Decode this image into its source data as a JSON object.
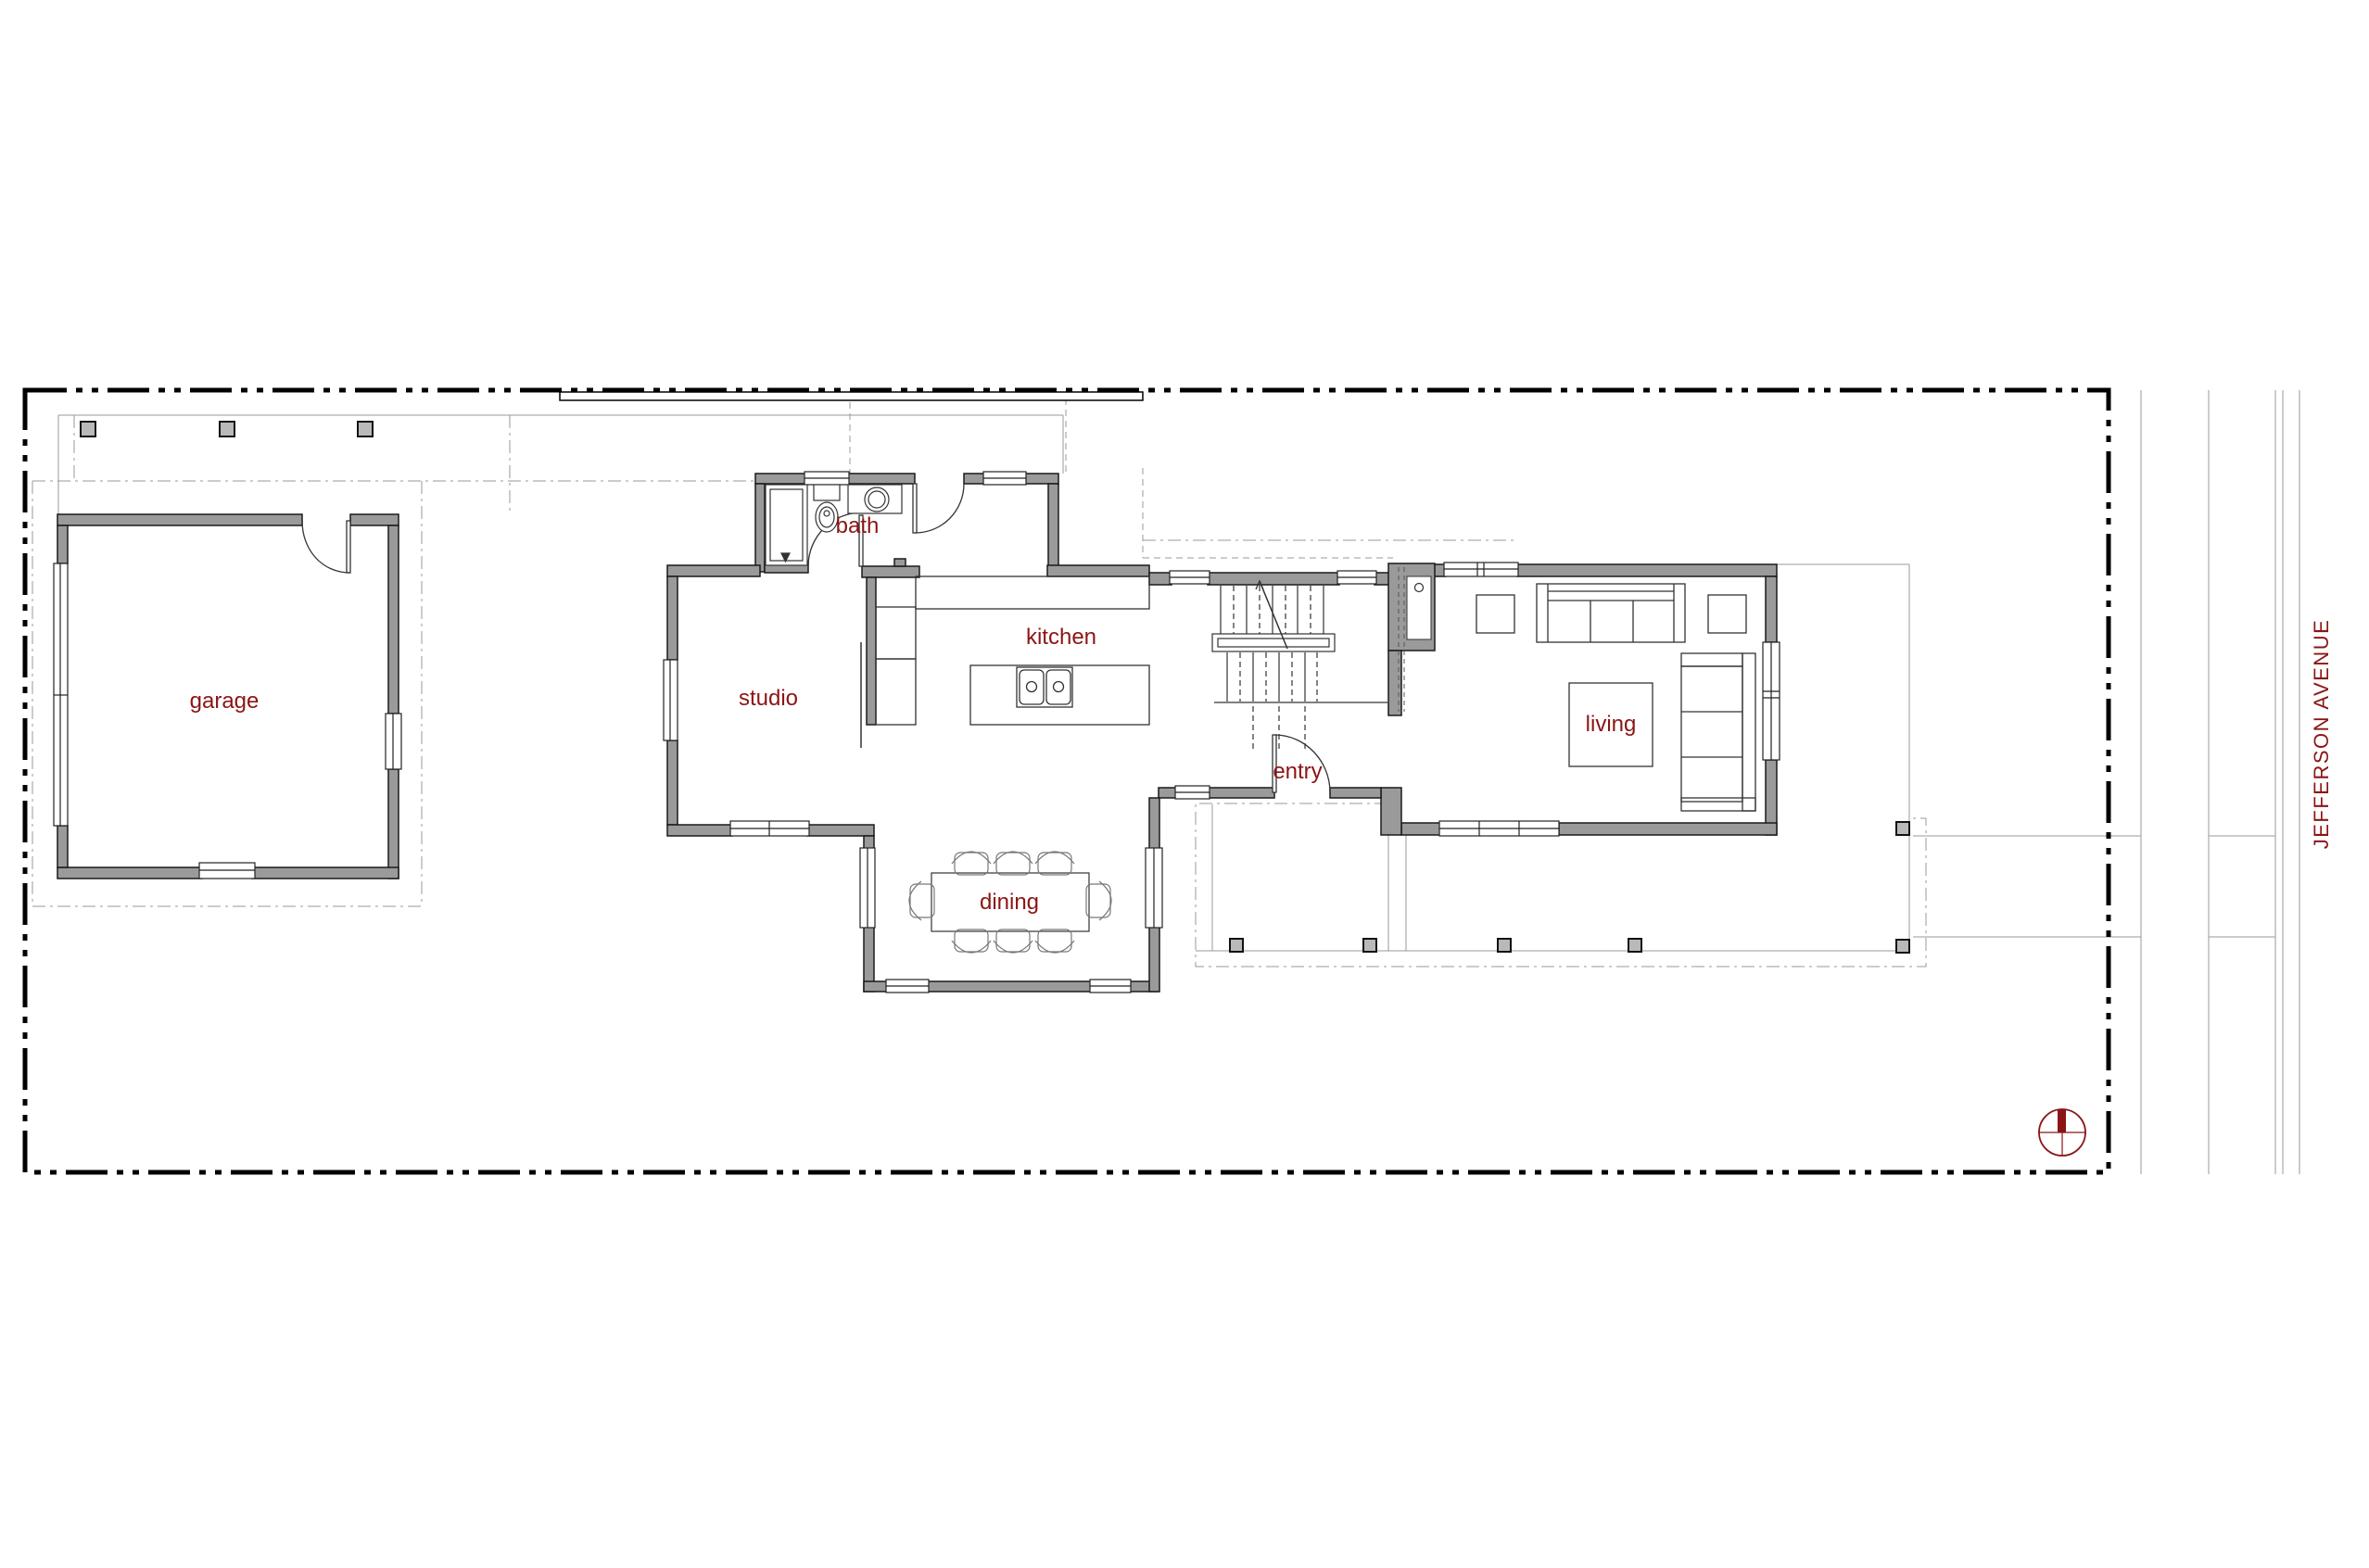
{
  "plan": {
    "rooms": {
      "garage": "garage",
      "studio": "studio",
      "bath": "bath",
      "kitchen": "kitchen",
      "entry": "entry",
      "living": "living",
      "dining": "dining"
    },
    "street": {
      "name": "JEFFERSON AVENUE"
    },
    "icons": {
      "north_arrow": "north-arrow"
    },
    "colors": {
      "label": "#8b1515",
      "wall_fill": "#9a9a9a",
      "wall_stroke": "#1a1a1a",
      "property_line": "#000000",
      "aux_line": "#999999",
      "furniture_line": "#333333"
    }
  }
}
